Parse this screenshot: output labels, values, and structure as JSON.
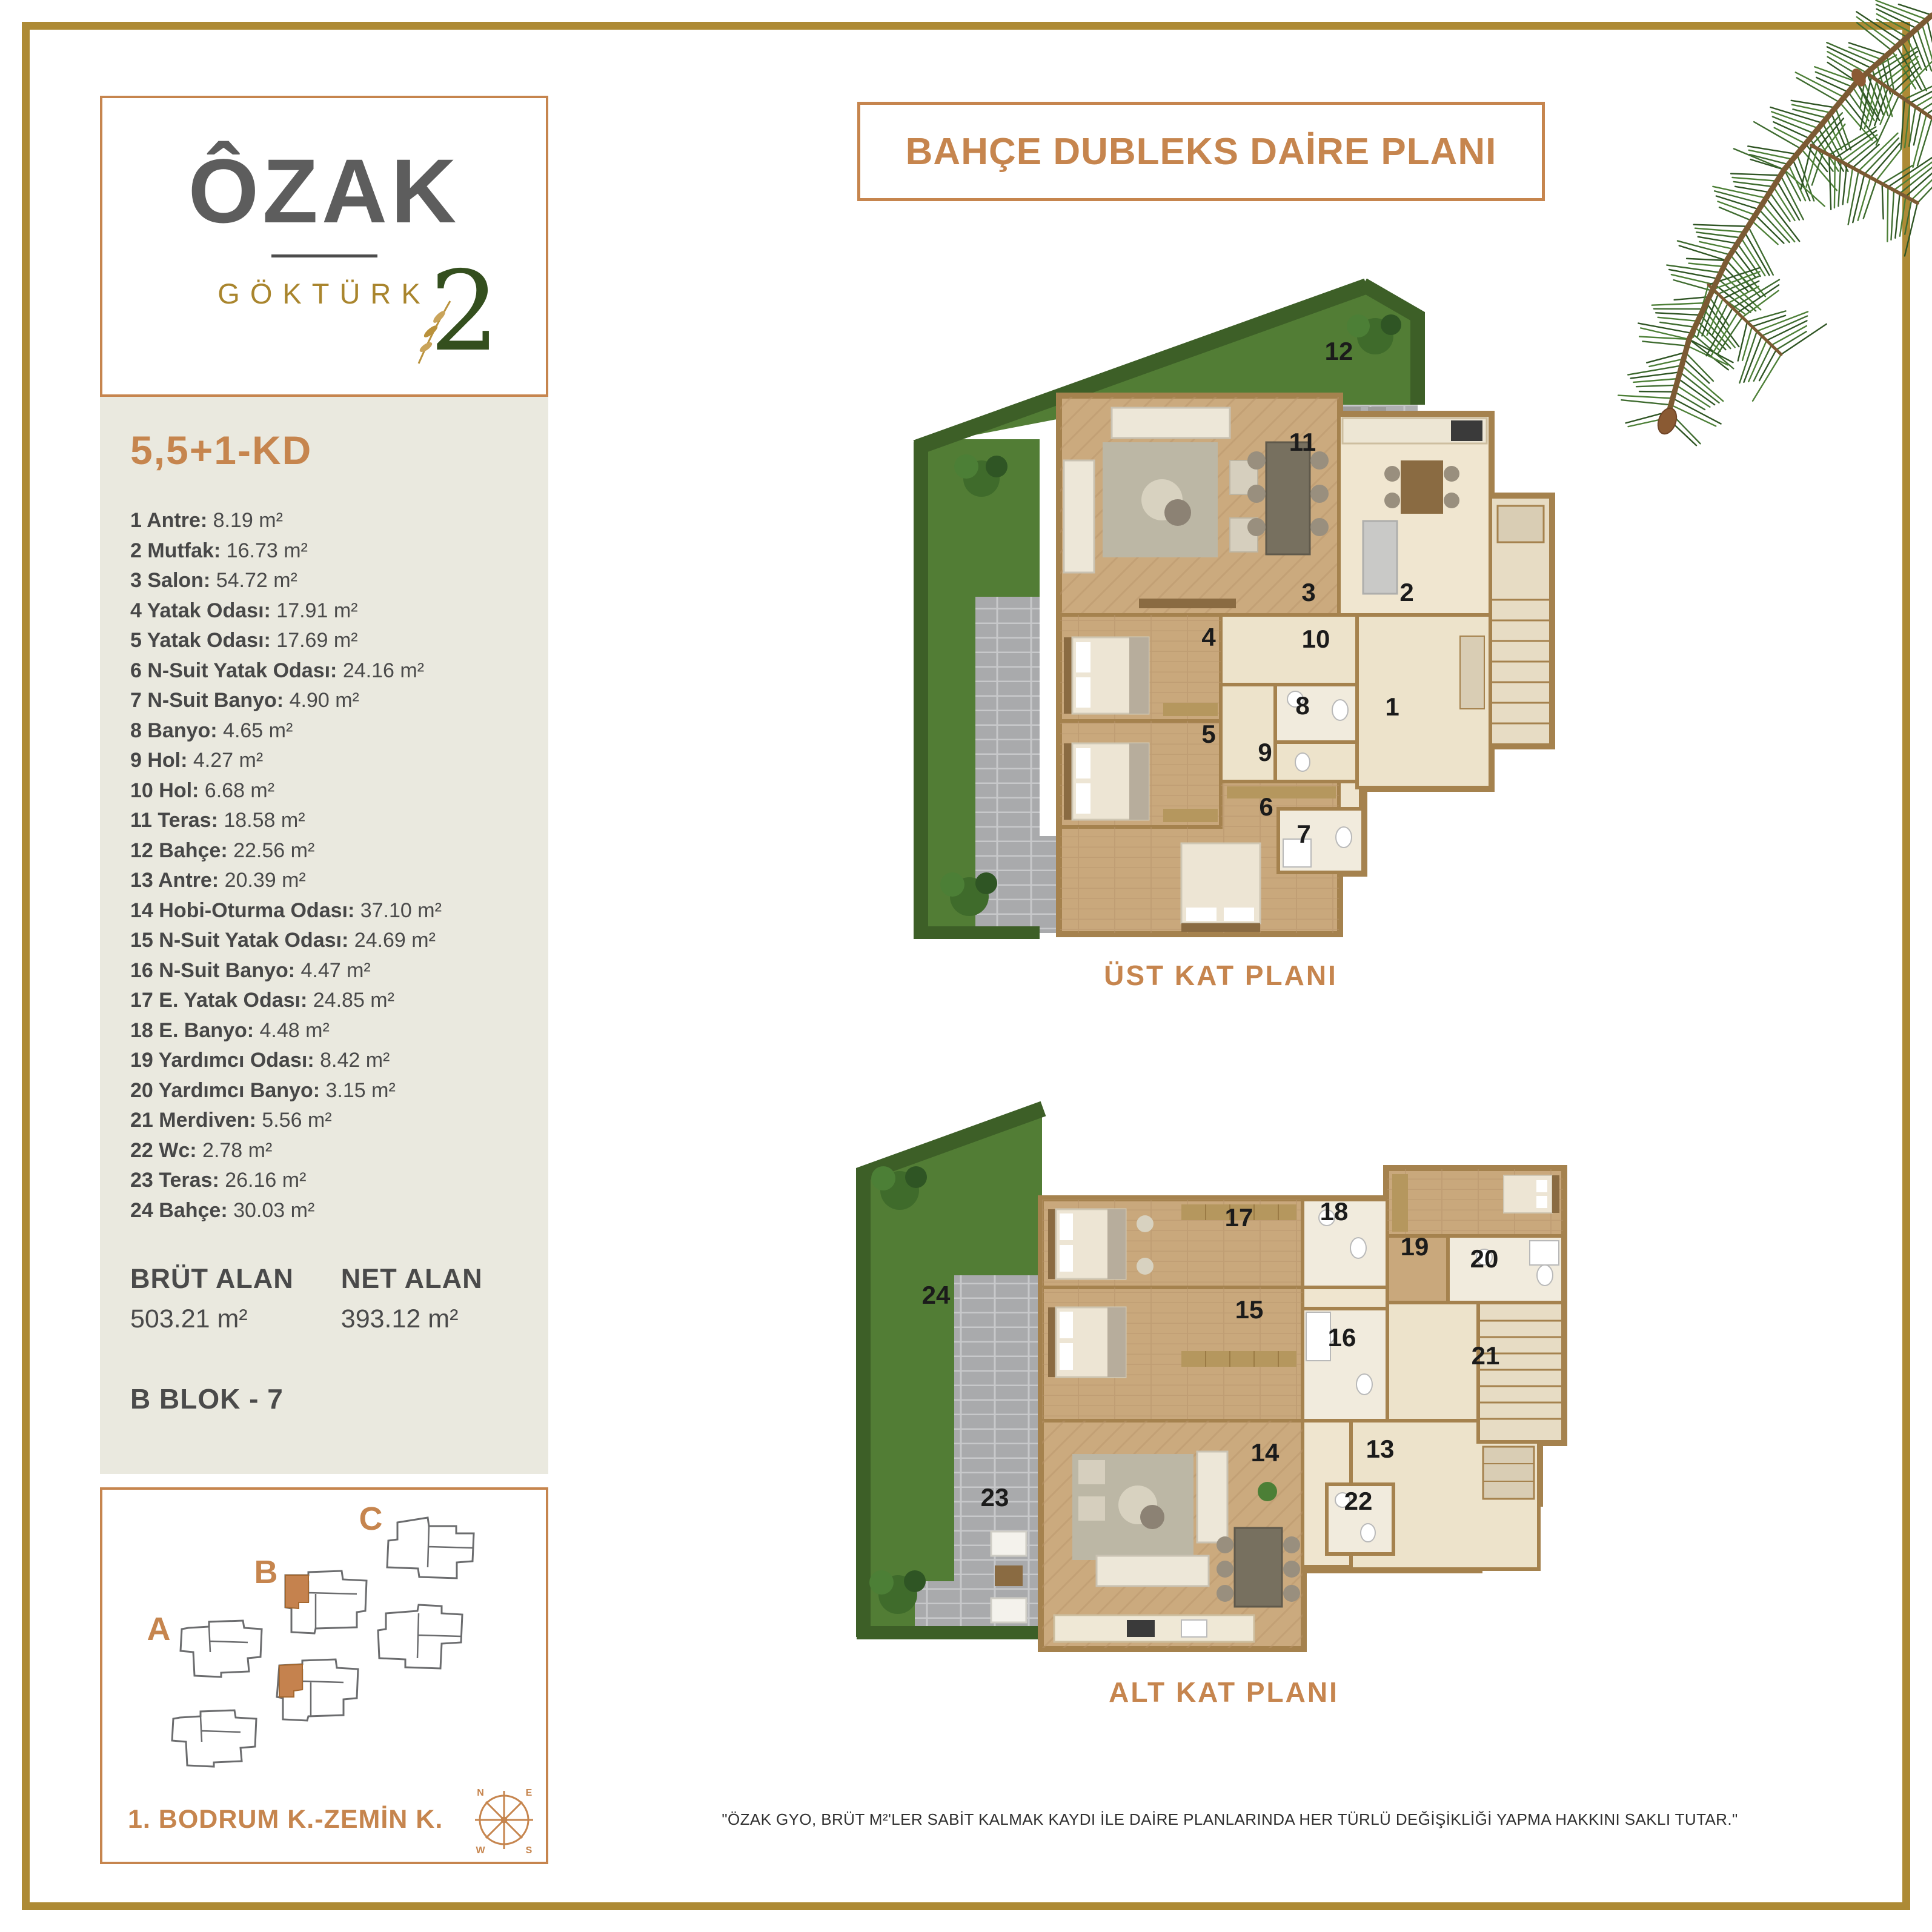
{
  "colors": {
    "accent": "#C6854E",
    "frame_gold": "#AD8A35",
    "panel_beige": "#EAE9DF",
    "logo_gray": "#5D5D5D",
    "logo_gold": "#A9852D",
    "logo_green": "#344F1E",
    "ink": "#4A4A4A"
  },
  "logo": {
    "brand": "ÔZAK",
    "project": "GÖKTÜRK",
    "number": "2"
  },
  "unit": {
    "type_label": "5,5+1-KD",
    "rooms": [
      {
        "label": "1 Antre:",
        "value": "8.19 m²"
      },
      {
        "label": "2 Mutfak:",
        "value": "16.73 m²"
      },
      {
        "label": "3 Salon:",
        "value": "54.72 m²"
      },
      {
        "label": "4 Yatak Odası:",
        "value": "17.91 m²"
      },
      {
        "label": "5 Yatak Odası:",
        "value": "17.69 m²"
      },
      {
        "label": "6 N-Suit Yatak Odası:",
        "value": "24.16 m²"
      },
      {
        "label": "7 N-Suit Banyo:",
        "value": "4.90 m²"
      },
      {
        "label": "8 Banyo:",
        "value": "4.65 m²"
      },
      {
        "label": "9 Hol:",
        "value": "4.27 m²"
      },
      {
        "label": "10 Hol:",
        "value": "6.68 m²"
      },
      {
        "label": "11 Teras:",
        "value": "18.58 m²"
      },
      {
        "label": "12 Bahçe:",
        "value": "22.56 m²"
      },
      {
        "label": "13 Antre:",
        "value": "20.39 m²"
      },
      {
        "label": "14 Hobi-Oturma Odası:",
        "value": "37.10 m²"
      },
      {
        "label": "15 N-Suit Yatak Odası:",
        "value": "24.69 m²"
      },
      {
        "label": "16 N-Suit Banyo:",
        "value": "4.47 m²"
      },
      {
        "label": "17 E. Yatak Odası:",
        "value": "24.85 m²"
      },
      {
        "label": "18 E. Banyo:",
        "value": "4.48 m²"
      },
      {
        "label": "19 Yardımcı Odası:",
        "value": "8.42 m²"
      },
      {
        "label": "20 Yardımcı Banyo:",
        "value": "3.15 m²"
      },
      {
        "label": "21 Merdiven:",
        "value": "5.56 m²"
      },
      {
        "label": "22 Wc:",
        "value": "2.78 m²"
      },
      {
        "label": "23 Teras:",
        "value": "26.16 m²"
      },
      {
        "label": "24 Bahçe:",
        "value": "30.03 m²"
      }
    ],
    "brut": {
      "label": "BRÜT ALAN",
      "value": "503.21 m²"
    },
    "net": {
      "label": "NET ALAN",
      "value": "393.12 m²"
    },
    "block": "B BLOK - 7"
  },
  "site": {
    "block_a": "A",
    "block_b": "B",
    "block_c": "C",
    "floor_label": "1. BODRUM K.-ZEMİN K.",
    "compass": {
      "n": "N",
      "e": "E",
      "w": "W",
      "s": "S"
    }
  },
  "header": {
    "title": "BAHÇE DUBLEKS DAİRE PLANI"
  },
  "plans": {
    "upper": {
      "label": "ÜST KAT PLANI",
      "numbers": [
        "1",
        "2",
        "3",
        "4",
        "5",
        "6",
        "7",
        "8",
        "9",
        "10",
        "11",
        "12"
      ]
    },
    "lower": {
      "label": "ALT KAT PLANI",
      "numbers": [
        "13",
        "14",
        "15",
        "16",
        "17",
        "18",
        "19",
        "20",
        "21",
        "22",
        "23",
        "24"
      ]
    }
  },
  "disclaimer": "\"ÖZAK GYO, BRÜT M²'LER SABİT KALMAK KAYDI İLE DAİRE PLANLARINDA HER TÜRLÜ DEĞİŞİKLİĞİ YAPMA HAKKINI SAKLI TUTAR.\""
}
